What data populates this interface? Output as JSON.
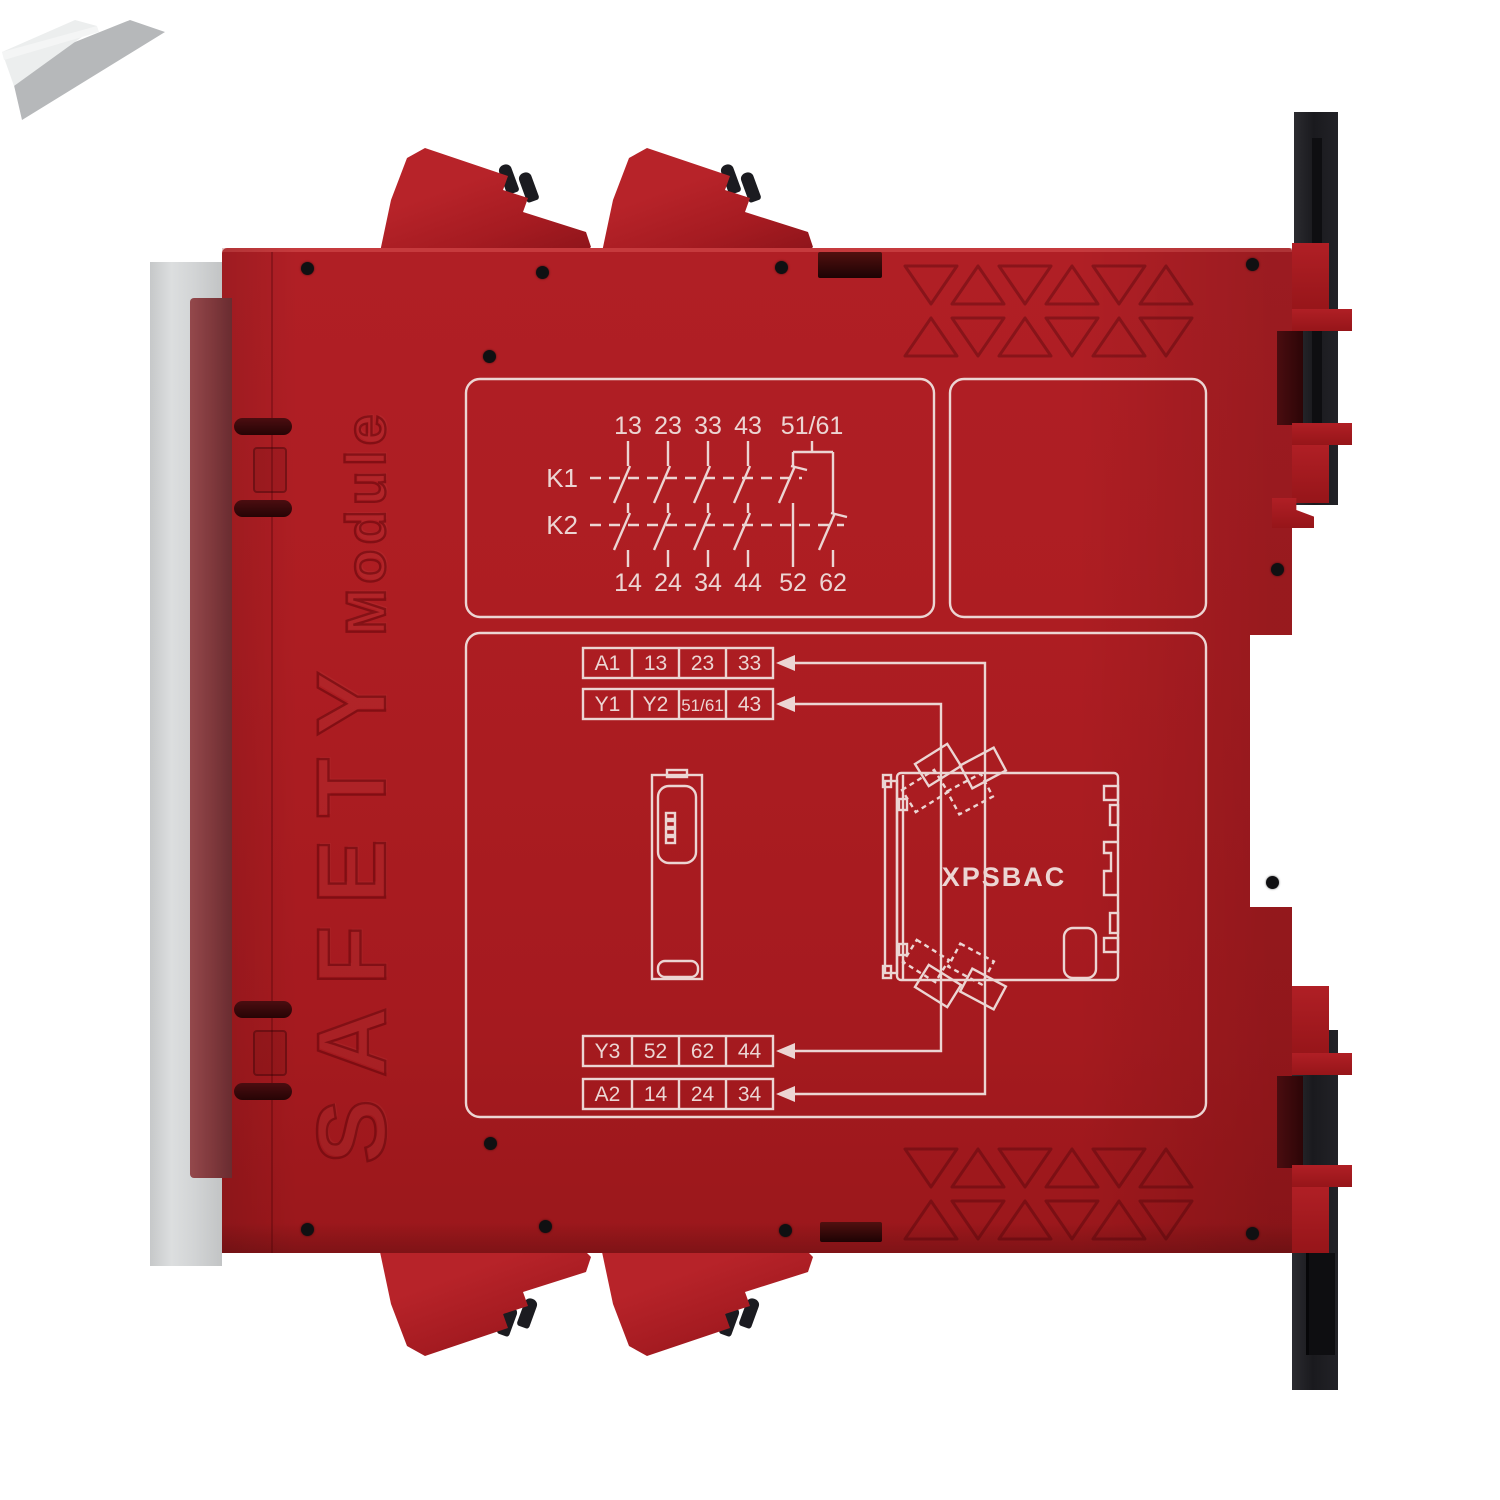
{
  "device": {
    "product_label": "XPSBAC",
    "emboss": {
      "line1": "SAFETY",
      "line2": "Module"
    },
    "contact_diagram": {
      "relay_rows": [
        "K1",
        "K2"
      ],
      "top_terminals": [
        "13",
        "23",
        "33",
        "43",
        "51/61"
      ],
      "bottom_terminals": [
        "14",
        "24",
        "34",
        "44",
        "52",
        "62"
      ]
    },
    "wiring_tables": [
      {
        "cells": [
          "A1",
          "13",
          "23",
          "33"
        ]
      },
      {
        "cells": [
          "Y1",
          "Y2",
          "51/61",
          "43"
        ]
      },
      {
        "cells": [
          "Y3",
          "52",
          "62",
          "44"
        ]
      },
      {
        "cells": [
          "A2",
          "14",
          "24",
          "34"
        ]
      }
    ],
    "colors": {
      "body_red": "#ac1c21",
      "print": "#ecd5d3",
      "din_rail_black": "#1b1b1f",
      "cover_grey": "#d3d5d6"
    }
  }
}
